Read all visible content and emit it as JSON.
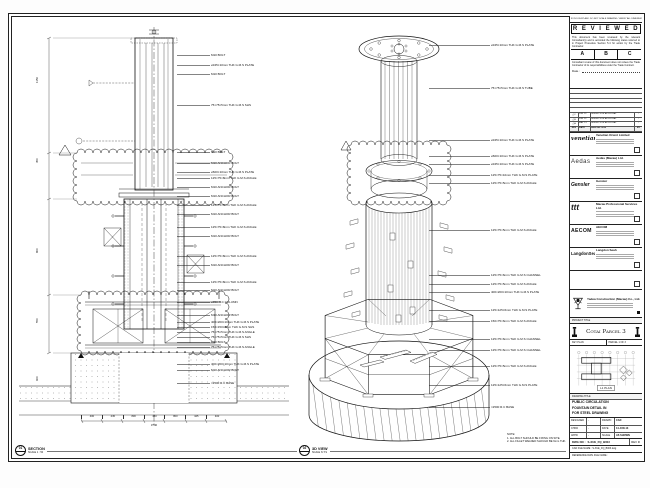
{
  "stamp": {
    "topline": "IF IN DOUBT ASK. DO NOT SCALE DRAWING. VERIFY ALL DIMENSIONS ON SITE.",
    "title": "R E V I E W E D",
    "para1": "This document has been reviewed by the relevant Consultant(s) and is accorded the following status referred to in Project Procedure Section 5.4 for action by the Trade Contractor.",
    "options": [
      "A",
      "B",
      "C"
    ],
    "para2": "Consultant review of this document does not relieve the Trade Contractor of its responsibilities under the Trade Contract.",
    "date_label": "Date :"
  },
  "revisions": {
    "header": {
      "rev": "REV",
      "date": "DATE",
      "description": "DESCRIPTION",
      "by": "BY"
    },
    "rows": [
      {
        "rev": "C",
        "date": "JUN 13",
        "description": "ISSUED FOR APPROVAL",
        "by": "-"
      },
      {
        "rev": "B",
        "date": "JUN 13",
        "description": "ISSUED FOR APPROVAL",
        "by": "-"
      },
      {
        "rev": "A",
        "date": "MAY 13",
        "description": "ISSUED FOR APPROVAL",
        "by": "-"
      }
    ]
  },
  "consultants": [
    {
      "cls": "logo-venetian",
      "logo": "venetian",
      "name": "Venetian Orient Limited"
    },
    {
      "cls": "logo-aedas",
      "logo": "Aedas",
      "name": "Aedas (Macau) Ltd."
    },
    {
      "cls": "logo-gensler",
      "logo": "Gensler",
      "name": "Gensler"
    },
    {
      "cls": "logo-mps",
      "logo": "ttt",
      "name": "Macau Professional Services Ltd."
    },
    {
      "cls": "logo-aecom",
      "logo": "AECOM",
      "name": "AECOM"
    },
    {
      "cls": "logo-langdon",
      "logo": "LangdonSeah",
      "name": "Langdon Seah"
    }
  ],
  "contractor": {
    "name": "Yadea Construction (Macau) Co., Ltd."
  },
  "project": {
    "label": "PROJECT TITLE",
    "title": "Cotai Parcel 3"
  },
  "keyplan": {
    "label": "KEY PLAN",
    "sheet": "PARCEL 1 OF 3",
    "caption": "L1 PLAN"
  },
  "drawing": {
    "label": "DRAWING TITLE",
    "title_lines": [
      {
        "t": "PUBLIC CIRCULATION"
      },
      {
        "t": "FOUNTAIN DETAIL IN"
      },
      {
        "t": "FOR STEEL DRAWING"
      }
    ],
    "fields": [
      {
        "l1": "DESIGNED",
        "v1": "-",
        "l2": "DRAWN",
        "v2": "CAD"
      },
      {
        "l1": "CHKD",
        "v1": "-",
        "l2": "DATE",
        "v2": "14-JUN-13"
      },
      {
        "l1": "APPD",
        "v1": "-",
        "l2": "SCALE",
        "v2": "AS SHOWN"
      }
    ],
    "dwg_label": "DWG NO :",
    "dwg_no": "S-XUE_FQ_B003",
    "rev_label": "REV",
    "rev": "C",
    "cad_label": "CAD FILE NAME :",
    "cad_file": "S-XUE_FQ_B003.dwg",
    "ref_label": "REFERENCE DWG FILE NAME :"
  },
  "section_view": {
    "tag": "01",
    "name": "SECTION",
    "scale": "SCALE 1 : 50",
    "labels": [
      {
        "y": 31,
        "text": "M10 BOLT"
      },
      {
        "y": 41,
        "text": "⌀345×10mm THK G.M.S PLATE"
      },
      {
        "y": 50,
        "text": "M10 BOLT"
      },
      {
        "y": 81,
        "text": "75×75×5mm THK G.M.S SHS"
      },
      {
        "y": 128,
        "text": "M10 BOLT"
      },
      {
        "y": 139,
        "text": "M10 ANCHOR BOLT"
      },
      {
        "y": 148,
        "text": "⌀600×10mm THK G.M.S PLATE"
      },
      {
        "y": 154,
        "text": "125×75×8mm THK G.M.S ANGLE"
      },
      {
        "y": 163,
        "text": "M10 ANCHOR BOLT"
      },
      {
        "y": 172,
        "text": "M10 ANCHOR BOLT"
      },
      {
        "y": 181,
        "text": "125×75×8mm THK G.M.S ANGLE"
      },
      {
        "y": 190,
        "text": "M10 ANCHOR BOLT"
      },
      {
        "y": 203,
        "text": "125×75×8mm THK G.M.S ANGLE"
      },
      {
        "y": 212,
        "text": "M10 ANCHOR BOLT"
      },
      {
        "y": 232,
        "text": "125×75×8mm THK G.M.S ANGLE"
      },
      {
        "y": 241,
        "text": "M10 ANCHOR BOLT"
      },
      {
        "y": 258,
        "text": "125×75×8mm THK G.M.S ANGLE"
      },
      {
        "y": 266,
        "text": "M10 ANCHOR BOLT"
      },
      {
        "y": 278,
        "text": "⌀350 R.C COLUMN"
      },
      {
        "y": 291,
        "text": "M10 ANCHOR BOLT"
      },
      {
        "y": 298,
        "text": "400×200×10mm THK G.M.S PLATE"
      },
      {
        "y": 303,
        "text": "150×150×8mm THK G.M.S SHS"
      },
      {
        "y": 308,
        "text": "75×75×5mm THK G.M.S ANGLE"
      },
      {
        "y": 313,
        "text": "75×75×5mm THK G.M.S SHS"
      },
      {
        "y": 318,
        "text": "M10 BOLT"
      },
      {
        "y": 323,
        "text": "75×75×5mm THK G.M.S ANGLE"
      },
      {
        "y": 340,
        "text": "400×200×10mm THK G.M.S PLATE"
      },
      {
        "y": 346,
        "text": "M10 ANCHOR BOLT"
      },
      {
        "y": 359,
        "text": "≈2500 R.C BASE"
      }
    ],
    "dims_left": [
      {
        "y": 60,
        "text": "1150"
      },
      {
        "y": 140,
        "text": "450"
      },
      {
        "y": 230,
        "text": "800"
      },
      {
        "y": 300,
        "text": "550"
      },
      {
        "y": 358,
        "text": "600"
      }
    ],
    "dims_bottom": [
      "400",
      "445",
      "800",
      "450",
      "800",
      "445",
      "400"
    ],
    "dims_total": "3740"
  },
  "iso_view": {
    "tag": "02",
    "name": "3D VIEW",
    "scale": "SCALE N.T.S",
    "labels": [
      {
        "y": 21,
        "text": "⌀345×10mm THK G.M.S PLATE"
      },
      {
        "y": 64,
        "text": "75×75×5mm THK G.M.S TUBE"
      },
      {
        "y": 116,
        "text": "⌀345×10mm THK G.M.S PLATE"
      },
      {
        "y": 132,
        "text": "⌀600×10mm THK G.M.S PLATE"
      },
      {
        "y": 140,
        "text": "⌀345×10mm THK G.M.S PLATE"
      },
      {
        "y": 151,
        "text": "125×75×10mm THK G.M.S PLATE"
      },
      {
        "y": 159,
        "text": "125×75×5mm THK G.M.S ANGLE"
      },
      {
        "y": 206,
        "text": "125×75×5mm THK G.M.S ANGLE"
      },
      {
        "y": 251,
        "text": "125×75×6mm THK G.M.S CHANNEL"
      },
      {
        "y": 260,
        "text": "125×75×5mm THK G.M.S ANGLE"
      },
      {
        "y": 268,
        "text": "400×200×10mm THK G.M.S PLATE"
      },
      {
        "y": 286,
        "text": "125×125×6mm THK G.M.S PLATE"
      },
      {
        "y": 297,
        "text": "150×75×6mm THK G.M.S ANGLE"
      },
      {
        "y": 315,
        "text": "125×75×6mm THK G.M.S CHANNEL"
      },
      {
        "y": 326,
        "text": "125×75×6mm THK G.M.S CHANNEL"
      },
      {
        "y": 342,
        "text": "125×75×5mm THK G.M.S ANGLE"
      },
      {
        "y": 361,
        "text": "125×125×6mm THK G.M.S PLATE"
      },
      {
        "y": 383,
        "text": "≈2500 R.C BASE"
      }
    ],
    "note_lines": [
      {
        "t": "NOTE:"
      },
      {
        "t": "1. ALL BOLT SHOULD BE FIXING ON SITE."
      },
      {
        "t": "2. ALL FILLET WELDED SHOULD BE 6mm THK."
      }
    ]
  }
}
